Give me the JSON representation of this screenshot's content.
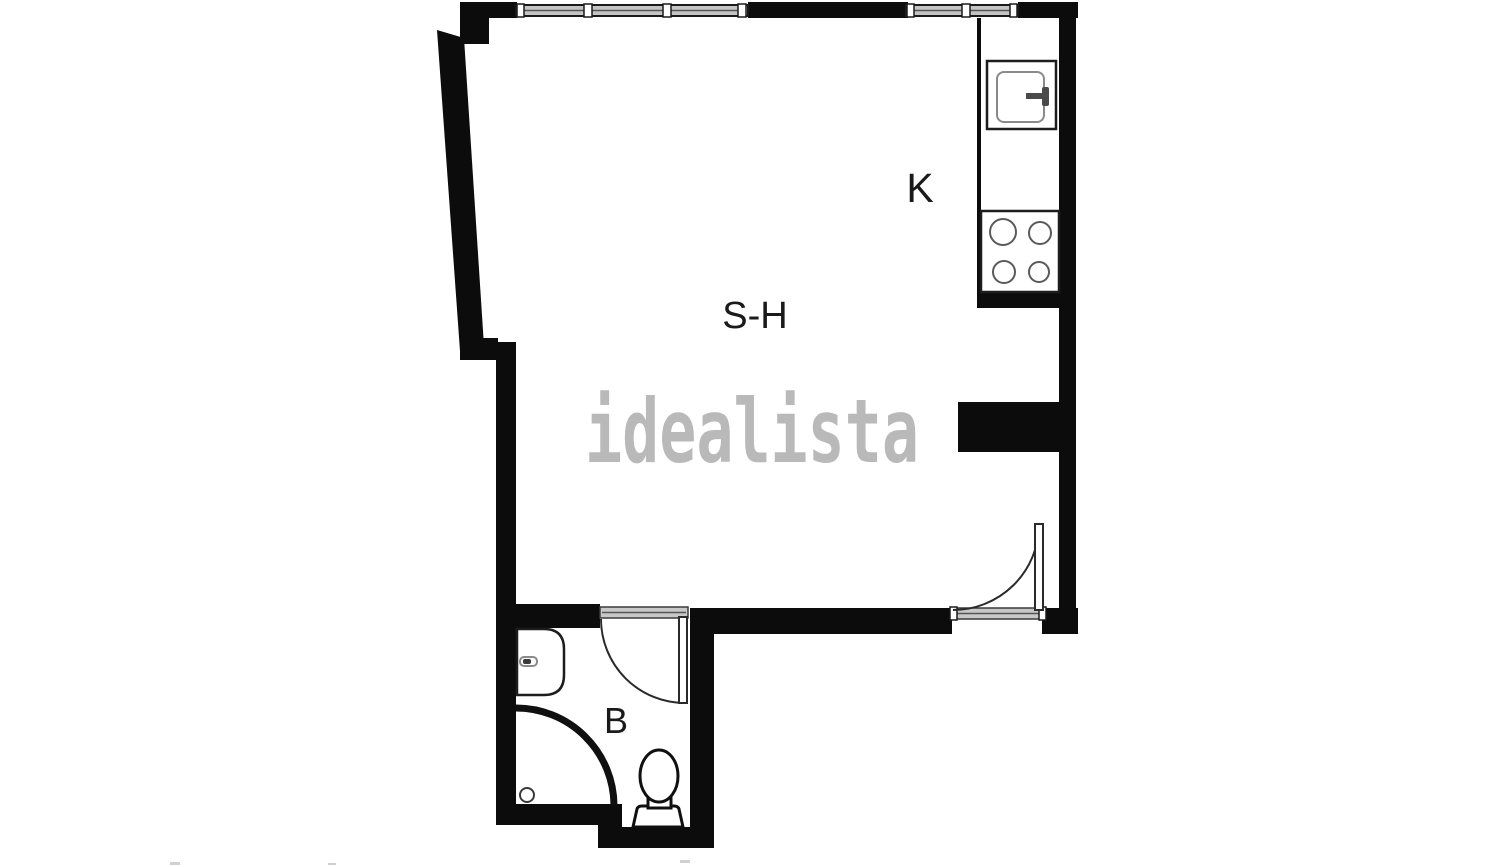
{
  "floorplan": {
    "background": "#ffffff",
    "watermark": {
      "text": "idealista",
      "color": "#b6b6b6"
    },
    "rooms": [
      {
        "id": "salon-comedor",
        "label": "S-H"
      },
      {
        "id": "kitchen",
        "label": "K"
      },
      {
        "id": "bathroom",
        "label": "B"
      }
    ],
    "colors": {
      "wall": "#0c0c0c",
      "fixture_outline": "#1d1d1d",
      "detail_gray": "#8a8a8a",
      "window_fill": "#c4c4c4",
      "threshold_fill": "#c8c8c8",
      "label_color": "#1a1a1a"
    },
    "fixtures": [
      "window-icon",
      "kitchen-sink-icon",
      "stove-icon",
      "kitchen-counter",
      "entrance-door-icon",
      "bathroom-door-icon",
      "bathroom-sink-icon",
      "shower-icon",
      "drain-icon",
      "toilet-icon"
    ]
  }
}
